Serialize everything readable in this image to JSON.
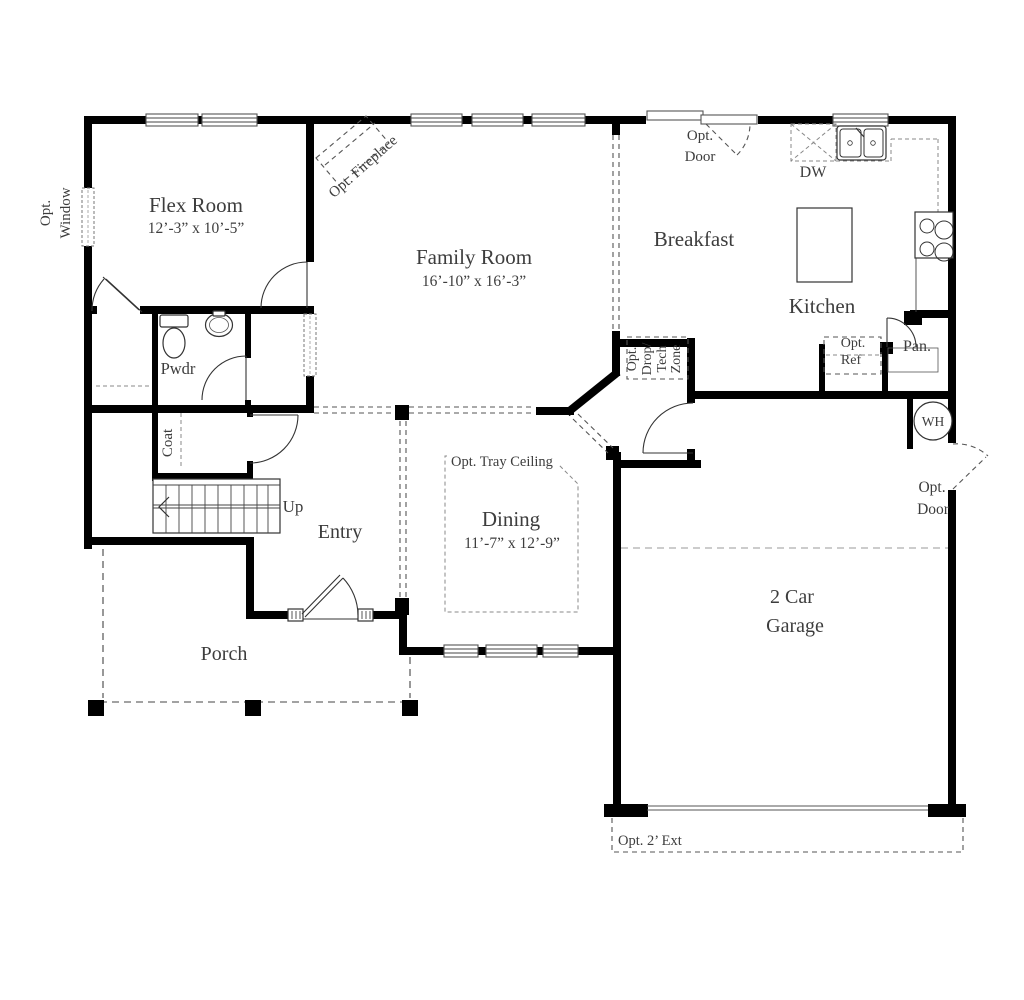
{
  "plan": {
    "rooms": {
      "flex": {
        "name": "Flex Room",
        "dims": "12’-3” x 10’-5”"
      },
      "family": {
        "name": "Family Room",
        "dims": "16’-10” x 16’-3”"
      },
      "breakfast": {
        "name": "Breakfast"
      },
      "kitchen": {
        "name": "Kitchen"
      },
      "dining": {
        "name": "Dining",
        "dims": "11’-7” x 12’-9”"
      },
      "entry": {
        "name": "Entry"
      },
      "porch": {
        "name": "Porch"
      },
      "garage": {
        "l1": "2 Car",
        "l2": "Garage"
      },
      "pwdr": {
        "name": "Pwdr"
      },
      "coat": {
        "name": "Coat"
      },
      "pantry": {
        "name": "Pan."
      }
    },
    "annotations": {
      "opt_window": {
        "l1": "Opt.",
        "l2": "Window"
      },
      "opt_fireplace": {
        "label": "Opt. Fireplace"
      },
      "opt_door_top": {
        "l1": "Opt.",
        "l2": "Door"
      },
      "opt_door_right": {
        "l1": "Opt.",
        "l2": "Door"
      },
      "dw": {
        "label": "DW"
      },
      "opt_ref": {
        "l1": "Opt.",
        "l2": "Ref"
      },
      "drop_zone": {
        "l1": "Opt.",
        "l2": "Drop/",
        "l3": "Tech",
        "l4": "Zone"
      },
      "wh": {
        "label": "WH"
      },
      "up": {
        "label": "Up"
      },
      "tray": {
        "label": "Opt. Tray Ceiling"
      },
      "ext": {
        "label": "Opt. 2’ Ext"
      }
    },
    "colors": {
      "wall": "#000000",
      "text": "#3d3d3d",
      "dashed": "#555555"
    }
  }
}
